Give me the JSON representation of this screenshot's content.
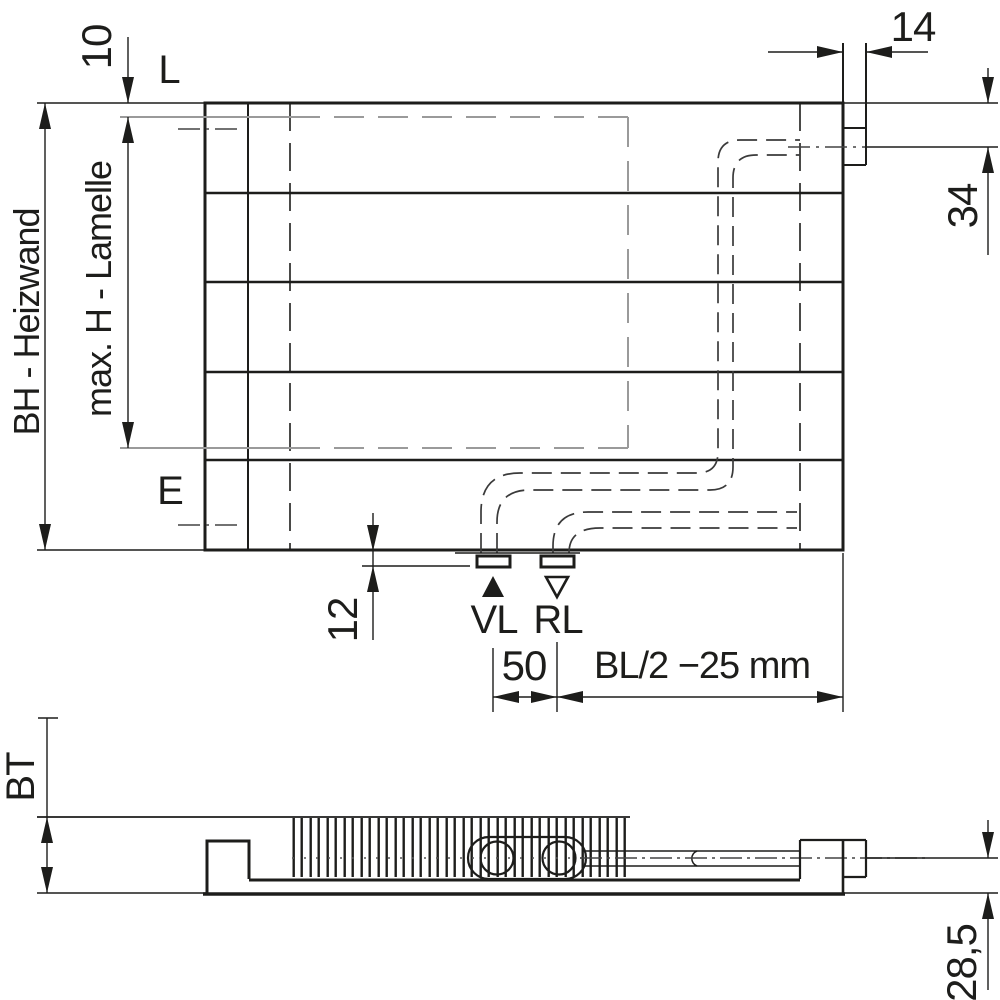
{
  "drawing": {
    "title": "Heizwand technical drawing",
    "front_view": {
      "labels": {
        "air_vent_level": "L",
        "drain_level": "E",
        "supply": "VL",
        "return": "RL"
      },
      "dimensions": {
        "lamelle_top_offset": "10",
        "vent_tab_width": "14",
        "connection_center_from_top": "34",
        "panel_height": "BH - Heizwand",
        "max_lamelle_height": "max. H - Lamelle",
        "stub_drop_below_panel": "12",
        "vl_rl_spacing": "50",
        "connection_to_edge": "BL/2 −25 mm"
      }
    },
    "bottom_view": {
      "dimensions": {
        "build_depth": "BT",
        "pipe_center_to_wall": "28,5"
      }
    },
    "colors": {
      "line": "#1d1d1b",
      "gray": "#9a9a9a",
      "pipe": "#3a3a3a",
      "background": "#ffffff"
    }
  }
}
